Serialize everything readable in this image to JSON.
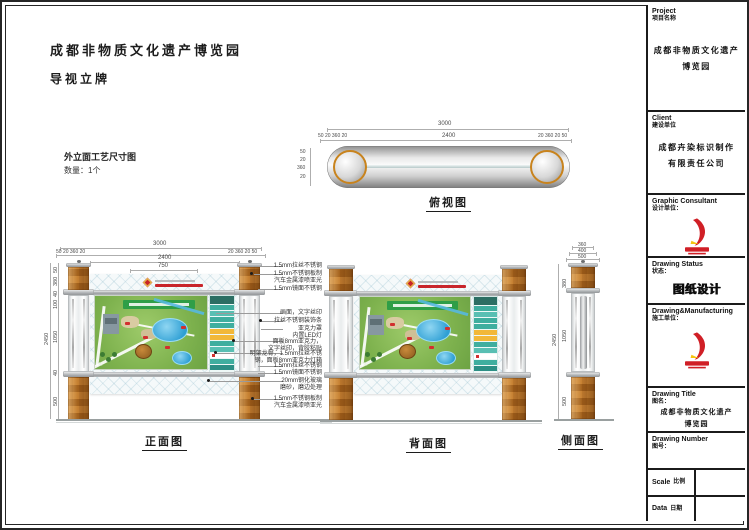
{
  "doc": {
    "project_title": "成都非物质文化遗产博览园",
    "subtitle": "导视立牌",
    "section_title": "外立面工艺尺寸图",
    "quantity": "数量：1个"
  },
  "views": {
    "top": {
      "label": "俯视图",
      "dims": {
        "overall": "3000",
        "inner": "2400",
        "left_segs": "50 20 360 20",
        "right_segs": "20 360 20 50",
        "side_segs": [
          "50",
          "20",
          "360",
          "20"
        ]
      }
    },
    "front": {
      "label": "正面图",
      "dims": {
        "overall": "3000",
        "inner": "2400",
        "header": "750",
        "left_segs": "50 20 360 20",
        "right_segs": "20 360 20 50",
        "total_height": "2450",
        "heights": [
          "50",
          "380",
          "40",
          "100",
          "1050",
          "40",
          "500"
        ]
      },
      "callouts": [
        {
          "text": "1.5mm拉丝不锈钢"
        },
        {
          "text": "1.5mm不锈钢板制\n汽车金属漆喷亚光"
        },
        {
          "text": "1.5mm镜面不锈钢"
        },
        {
          "text": "画面，文字丝印"
        },
        {
          "text": "拉丝不锈钢装饰条"
        },
        {
          "text": "亚克力罩\n内置LED灯"
        },
        {
          "text": "面板8mm亚克力，\n文字丝印，背胶粘贴"
        },
        {
          "text": "明架龙骨，1.5mm拉丝不锈\n钢，面板8mm亚克力灯箱"
        },
        {
          "text": "1.5mm拉丝不锈钢"
        },
        {
          "text": "1.5mm镜面不锈钢"
        },
        {
          "text": "20mm钢化玻璃\n磨砂，磨边处理"
        },
        {
          "text": "1.5mm不锈钢板制\n汽车金属漆喷亚光"
        }
      ]
    },
    "back": {
      "label": "背面图"
    },
    "side": {
      "label": "侧面图",
      "dims": {
        "total_height": "2450",
        "heights": [
          "380",
          "1050",
          "500"
        ],
        "widths": [
          "360",
          "400",
          "500"
        ]
      }
    }
  },
  "titleblock": {
    "project": {
      "en": "Project",
      "zh": "项目名称",
      "value": "成都非物质文化遗产\n博览园"
    },
    "client": {
      "en": "Client",
      "zh": "建设单位",
      "value": "成都卉染标识制作\n有限责任公司"
    },
    "consultant": {
      "en": "Graphic Consultant",
      "zh": "设计单位："
    },
    "status": {
      "en": "Drawing Status",
      "zh": "状态：",
      "value": "图纸设计"
    },
    "manufacturing": {
      "en": "Drawing&Manufacturing",
      "zh": "施工单位："
    },
    "drawing_title": {
      "en": "Drawing Title",
      "zh": "图名：",
      "value": "成都非物质文化遗产\n博览园"
    },
    "drawing_number": {
      "en": "Drawing Number",
      "zh": "图号："
    },
    "scale": {
      "en": "Scale",
      "zh": "比例"
    },
    "date": {
      "en": "Data",
      "zh": "日期"
    }
  },
  "colors": {
    "wood_orange": "#c07a28",
    "steel_silver": "#c6c9cb",
    "accent_red": "#d01f26",
    "legend_teal": "#3fae9f",
    "legend_yellow": "#f2b838",
    "map_green": "#7eb24e",
    "lake_blue": "#3aa6d9"
  }
}
